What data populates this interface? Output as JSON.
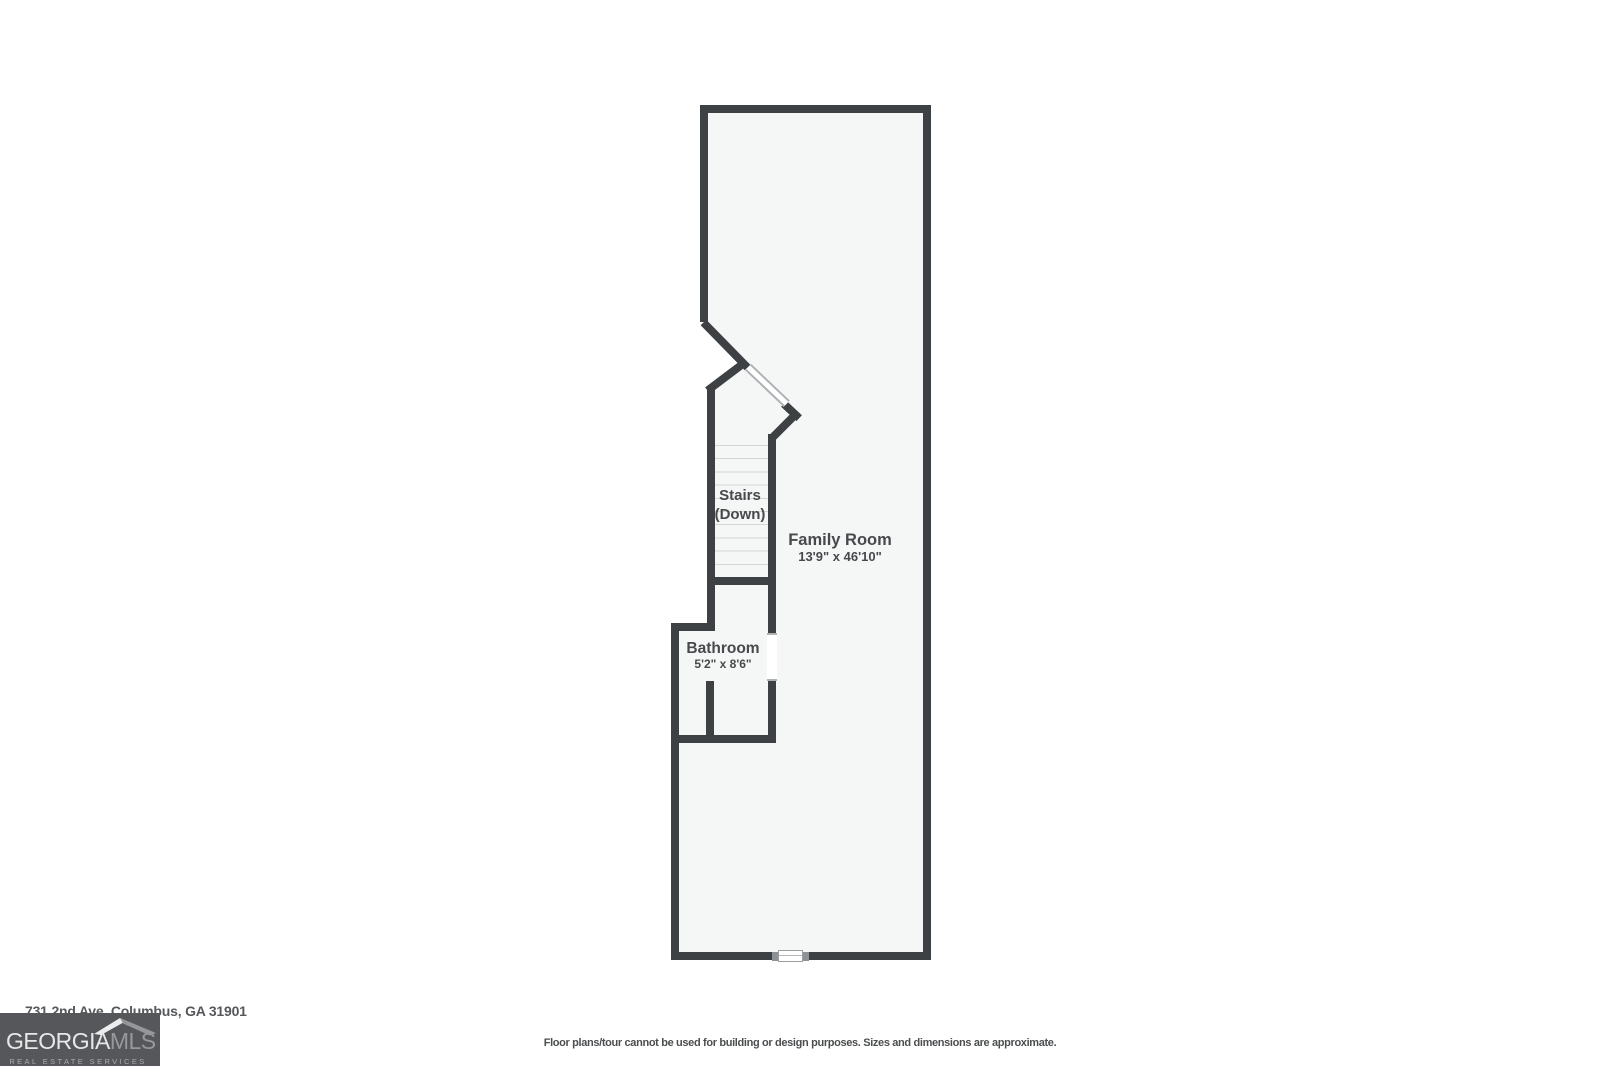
{
  "canvas": {
    "width": 1600,
    "height": 1066,
    "background": "#ffffff"
  },
  "palette": {
    "wall": "#3e4144",
    "floor": "#f5f6f6",
    "stair_tread_line": "#d3d5d7",
    "door_window_line": "#aeb2b5",
    "room_label_text": "#47494c",
    "footer_text": "#4b4d4f"
  },
  "floor_plan": {
    "rooms": [
      {
        "name": "Family Room",
        "dimensions": "13'9\" x 46'10\""
      },
      {
        "name": "Stairs",
        "sub": "(Down)"
      },
      {
        "name": "Bathroom",
        "dimensions": "5'2\" x 8'6\""
      }
    ]
  },
  "footer": {
    "address": "731 2nd Ave, Columbus, GA 31901",
    "disclaimer": "Floor plans/tour cannot be used for building or design purposes. Sizes and dimensions are approximate."
  },
  "logo": {
    "brand_primary": "GEORGIA",
    "brand_secondary": "MLS",
    "tagline": "REAL ESTATE SERVICES",
    "background": "#56575a",
    "primary_color": "#e6e7e8",
    "secondary_color": "#96989a"
  }
}
